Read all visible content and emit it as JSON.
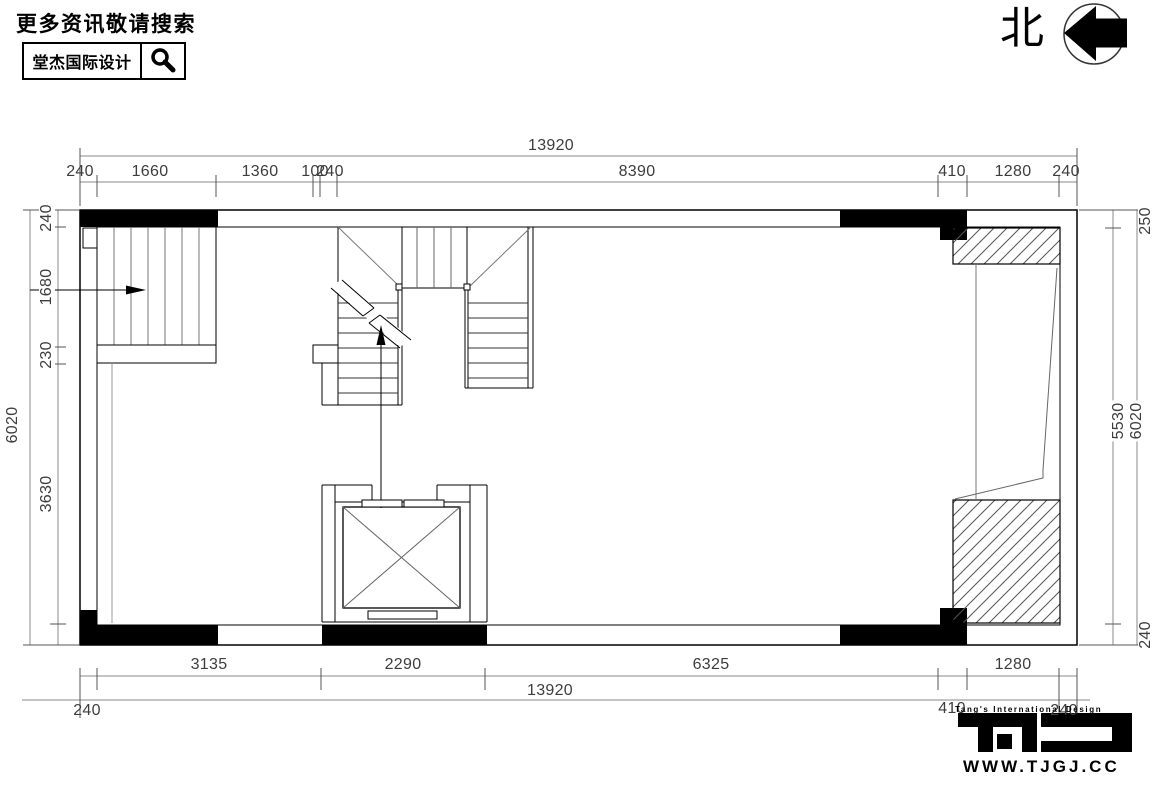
{
  "header": {
    "search_note": "更多资讯敬请搜索",
    "brand_name": "堂杰国际设计"
  },
  "north_indicator": {
    "label": "北"
  },
  "plan": {
    "dims_top": {
      "overall": "13920",
      "segments": [
        "240",
        "1660",
        "1360",
        "100",
        "240",
        "8390",
        "410",
        "1280",
        "240"
      ]
    },
    "dims_bottom": {
      "overall": "13920",
      "segments": [
        "3135",
        "2290",
        "6325",
        "1280"
      ],
      "small_segments": [
        "240",
        "410",
        "240"
      ]
    },
    "dims_left": {
      "overall": "6020",
      "segments": [
        "240",
        "1680",
        "230",
        "3630"
      ]
    },
    "dims_right": {
      "overall": "6020",
      "segments": [
        "250",
        "5530",
        "240"
      ]
    }
  },
  "footer_brand": {
    "tagline": "Tang's International Design",
    "website": "WWW.TJGJ.CC"
  }
}
